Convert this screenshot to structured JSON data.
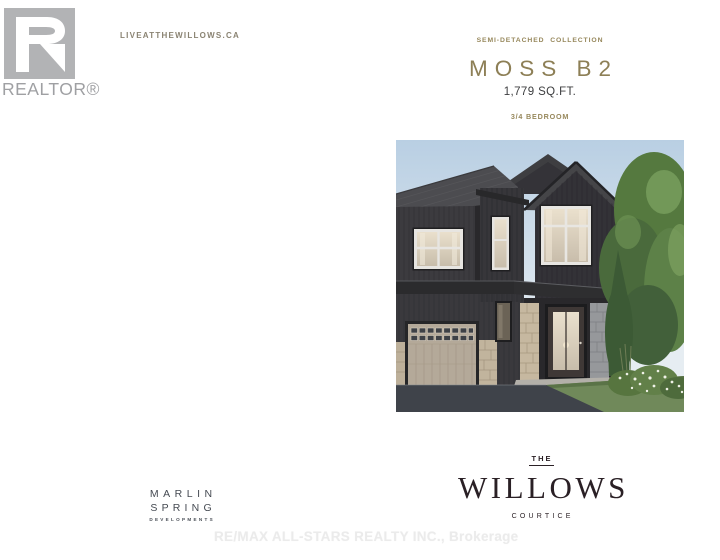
{
  "realtor": {
    "label": "REALTOR®",
    "logo_color": "#b2b3b5"
  },
  "header": {
    "website": "LIVEATTHEWILLOWS.CA"
  },
  "plan": {
    "collection": "SEMI-DETACHED COLLECTION",
    "model": "MOSS B2",
    "area": "1,779 SQ.FT.",
    "bedrooms": "3/4 BEDROOM",
    "accent_color": "#8d7f56"
  },
  "rendering": {
    "label": "semi-detached-home-rendering"
  },
  "developer": {
    "line1": "MARLIN",
    "line2": "SPRING",
    "line3": "DEVELOPMENTS"
  },
  "community": {
    "prefix": "THE",
    "name": "WILLOWS",
    "city": "COURTICE"
  },
  "watermark": {
    "text": "RE/MAX ALL-STARS REALTY INC., Brokerage"
  }
}
